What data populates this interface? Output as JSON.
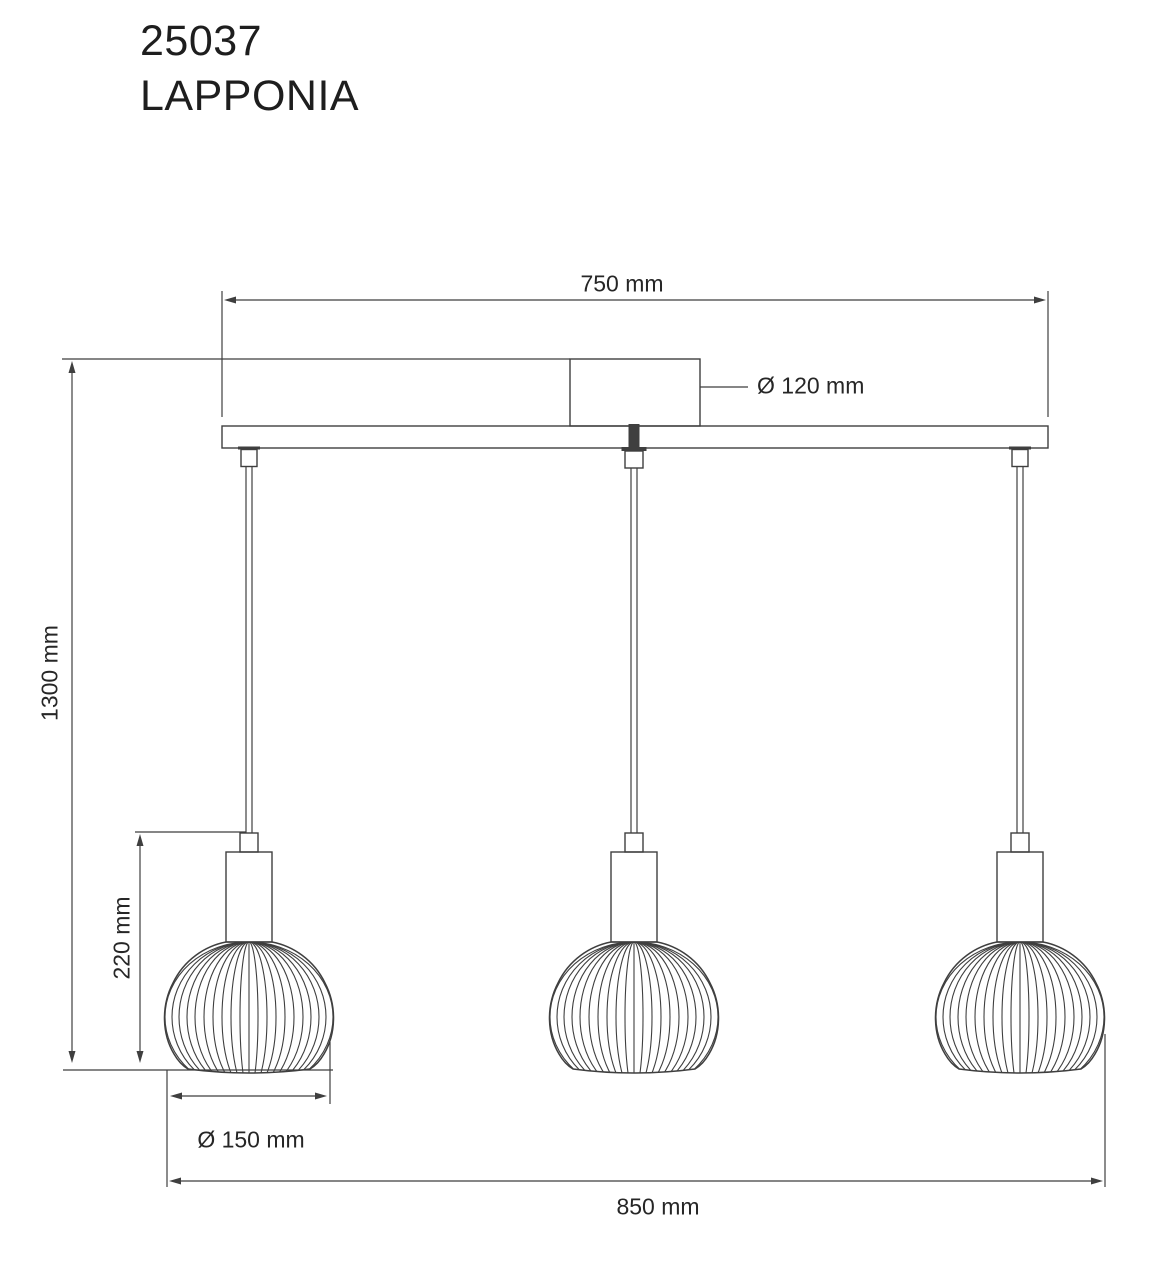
{
  "title": {
    "model": "25037",
    "name": "LAPPONIA"
  },
  "dimensions": {
    "rail_width": "750 mm",
    "canopy_diameter": "Ø 120 mm",
    "drop_height": "1300 mm",
    "shade_height": "220 mm",
    "shade_diameter": "Ø 150 mm",
    "overall_width": "850 mm"
  },
  "colors": {
    "line": "#3f3f3f",
    "text": "#262626",
    "background": "#ffffff"
  }
}
